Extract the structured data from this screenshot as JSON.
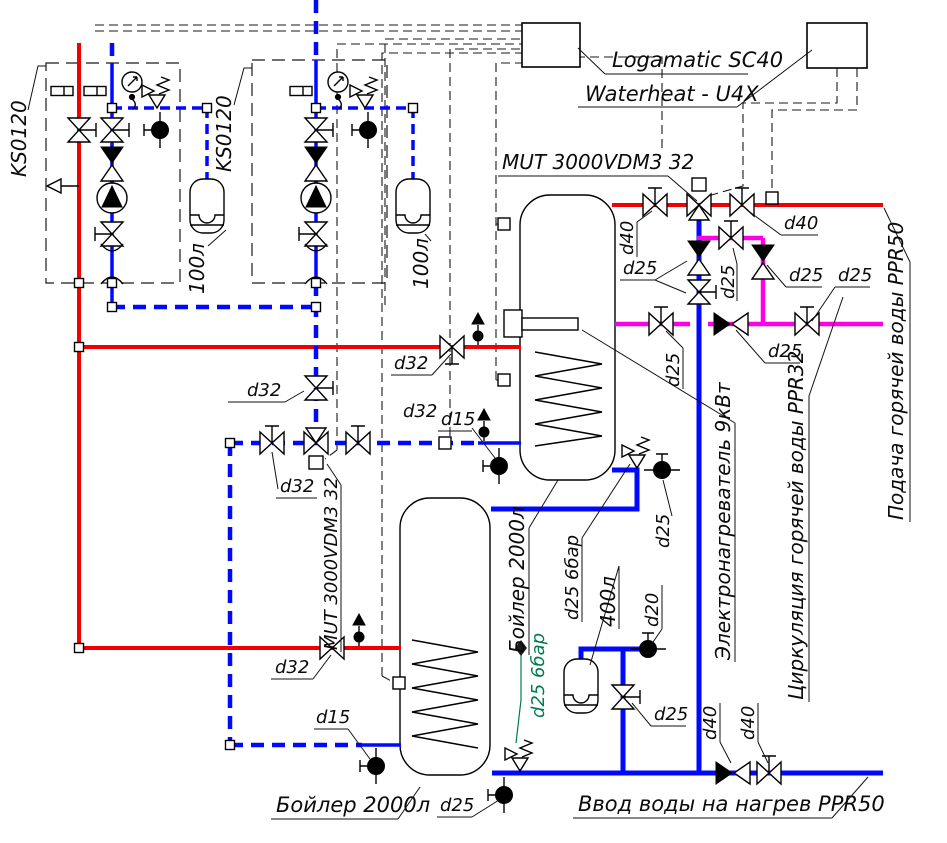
{
  "colors": {
    "supply_red": "#f00000",
    "water_blue": "#0008ff",
    "circulation_magenta": "#ff00e6",
    "note_green": "#007d4f"
  },
  "controllers": {
    "logamatic": "Logamatic SC40",
    "waterheat": "Waterheat - U4X"
  },
  "modules": {
    "module1": "KS0120",
    "module2": "KS0120",
    "module1_tank": "100л",
    "module2_tank": "100л"
  },
  "equipment": {
    "mut_valve_top": "MUT 3000VDM3 32",
    "mut_valve_lower": "MUT 3000VDM3 32",
    "boiler_upper": "Бойлер 2000л",
    "boiler_lower": "Бойлер 2000л",
    "electric_heater": "Электронагреватель 9кВт",
    "expansion_tank_400": "400л",
    "safety_upper": "d25 6бар",
    "safety_lower": "d25 6бар"
  },
  "pipes": {
    "hot_supply": "Подача горячей воды PPR50",
    "circulation": "Циркуляция горячей воды PPR32",
    "cold_inlet": "Ввод воды на нагрев PPR50"
  },
  "sizes": {
    "d40_supply_valve_left": "d40",
    "d40_supply_valve_right": "d40",
    "d25_heater_line": "d25",
    "d25_circ_upper_valve": "d25",
    "d25_circ_upper_check": "d25",
    "d25_circ_right_valve": "d25",
    "d25_circ_check": "d25",
    "d25_circ_left_valve": "d25",
    "d25_upper_drain": "d25",
    "d25_exp_valve": "d25",
    "d25_lower_drain": "d25",
    "d32_loop_left_valve": "d32",
    "d32_riser_valve": "d32",
    "d32_loop_right_valve": "d32",
    "d32_supply_valve_mid": "d32",
    "d32_supply_valve_low": "d32",
    "d15_sensor_line": "d15",
    "d15_feed_valve": "d15",
    "d20_fill_valve": "d20",
    "d40_inlet_check": "d40",
    "d40_inlet_valve": "d40"
  }
}
